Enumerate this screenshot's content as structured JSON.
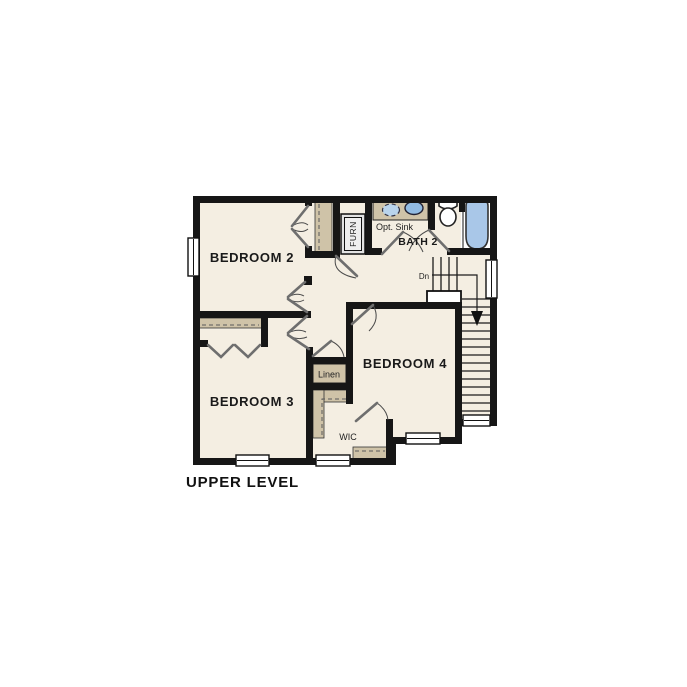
{
  "title": "UPPER LEVEL",
  "rooms": {
    "bedroom2": "BEDROOM 2",
    "bedroom3": "BEDROOM 3",
    "bedroom4": "BEDROOM 4",
    "bath2": "BATH 2"
  },
  "labels": {
    "opt_sink": "Opt. Sink",
    "linen": "Linen",
    "wic": "WIC",
    "furn": "FURN",
    "dn": "Dn"
  },
  "colors": {
    "floor": "#f4eee2",
    "wall": "#161616",
    "cabinet": "#cfc3a8",
    "tub": "#a9c7e8",
    "sink": "#92bce3",
    "sinkopt": "#b9d4ec"
  }
}
